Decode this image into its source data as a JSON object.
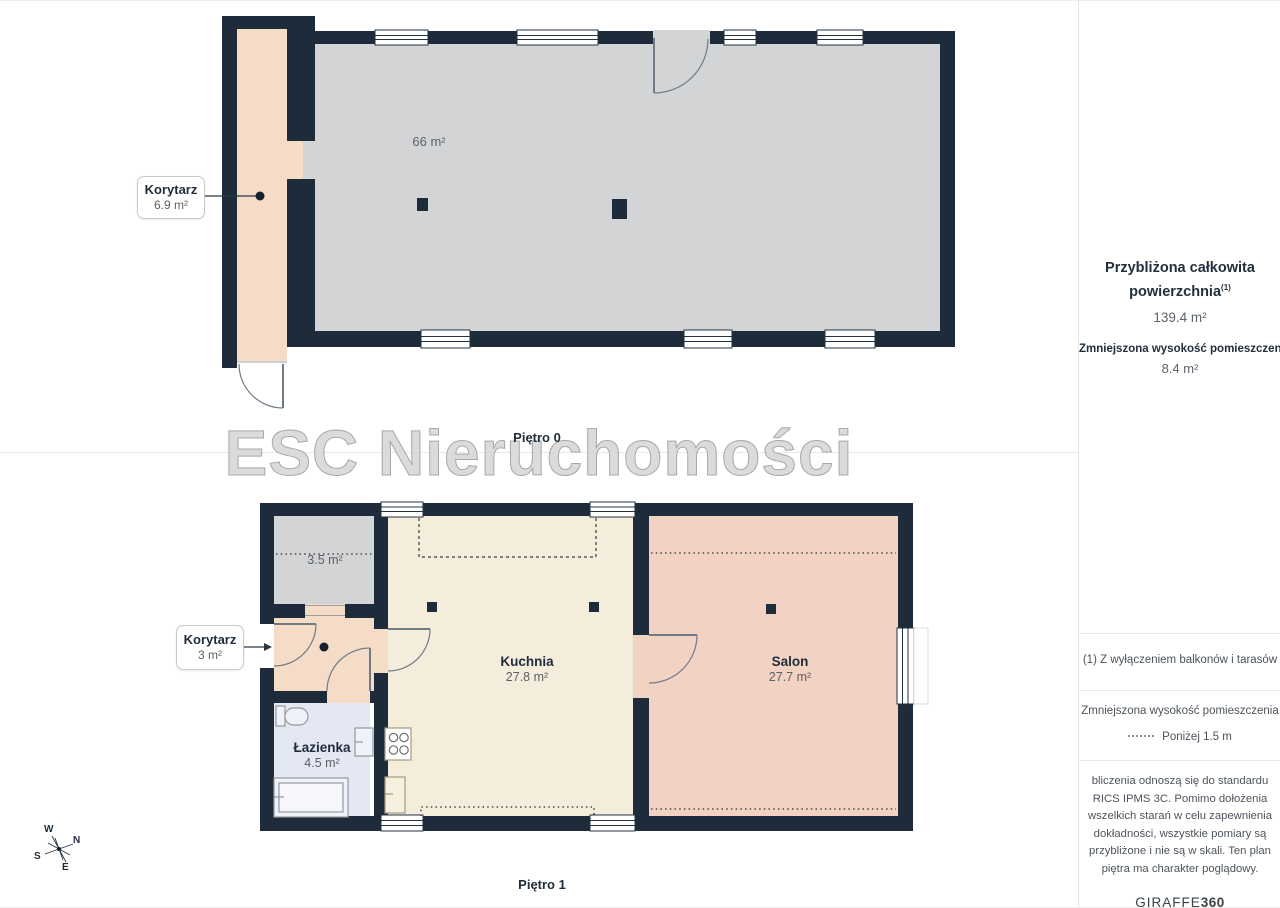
{
  "page": {
    "watermark": "ESC Nieruchomości"
  },
  "floor0": {
    "name": "Piętro 0",
    "main_room_area": "66 m²",
    "corridor": {
      "name": "Korytarz",
      "area": "6.9 m²"
    }
  },
  "floor1": {
    "name": "Piętro 1",
    "storage_area": "3.5 m²",
    "corridor": {
      "name": "Korytarz",
      "area": "3 m²"
    },
    "bathroom": {
      "name": "Łazienka",
      "area": "4.5 m²"
    },
    "kitchen": {
      "name": "Kuchnia",
      "area": "27.8 m²"
    },
    "living_room": {
      "name": "Salon",
      "area": "27.7 m²"
    }
  },
  "compass": {
    "n": "N",
    "e": "E",
    "s": "S",
    "w": "W"
  },
  "sidebar": {
    "total_area_title_line1": "Przybliżona całkowita",
    "total_area_title_line2": "powierzchnia",
    "total_area_footnote_marker": "(1)",
    "total_area_value": "139.4 m²",
    "reduced_height_title": "Zmniejszona wysokość pomieszczenia",
    "reduced_height_value": "8.4 m²",
    "footnote": "(1) Z wyłączeniem balkonów i tarasów",
    "legend_title": "Zmniejszona wysokość pomieszczenia",
    "legend_value": "Poniżej 1.5 m",
    "disclaimer": "bliczenia odnoszą się do standardu\nRICS IPMS 3C. Pomimo dołożenia\nwszelkich starań w celu zapewnienia\ndokładności, wszystkie pomiary są\nprzybliżone i nie są w skali. Ten plan\npiętra ma charakter poglądowy.",
    "brand_name": "GIRAFFE",
    "brand_number": "360"
  },
  "colors": {
    "wall": "#1e2b3a",
    "floor_gray": "#d3d4d5",
    "floor_peach": "#f4dcc7",
    "floor_cream": "#f4eddb",
    "floor_pink": "#f2d3c3",
    "floor_blue": "#e4e8f3",
    "accent_text": "#1f2c3a"
  }
}
